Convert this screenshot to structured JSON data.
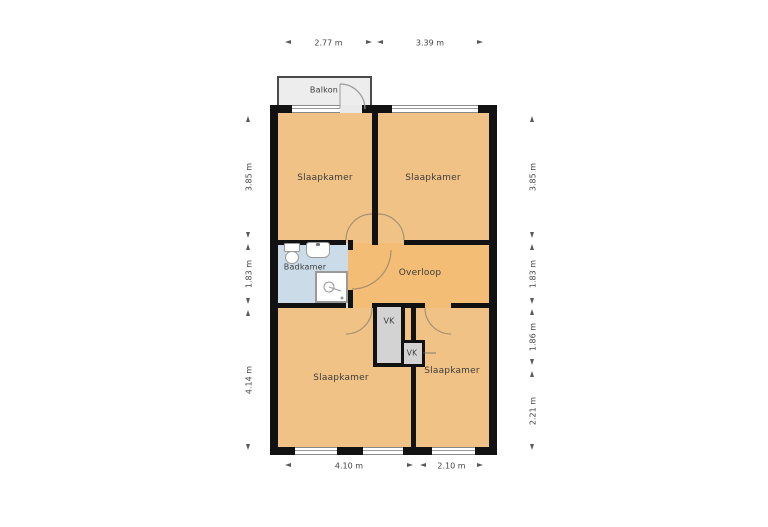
{
  "plan": {
    "type": "floor-plan",
    "rooms": {
      "balkon": {
        "label": "Balkon"
      },
      "slaapkamer_top_left": {
        "label": "Slaapkamer"
      },
      "slaapkamer_top_right": {
        "label": "Slaapkamer"
      },
      "badkamer": {
        "label": "Badkamer"
      },
      "overloop": {
        "label": "Overloop"
      },
      "slaapkamer_bottom_left": {
        "label": "Slaapkamer"
      },
      "slaapkamer_bottom_right": {
        "label": "Slaapkamer"
      },
      "vk_large": {
        "label": "VK"
      },
      "vk_small": {
        "label": "VK"
      }
    },
    "dimensions": {
      "top": [
        {
          "label": "2.77 m"
        },
        {
          "label": "3.39 m"
        }
      ],
      "bottom": [
        {
          "label": "4.10 m"
        },
        {
          "label": "2.10 m"
        }
      ],
      "left": [
        {
          "label": "3.85 m"
        },
        {
          "label": "1.83 m"
        },
        {
          "label": "4.14 m"
        }
      ],
      "right": [
        {
          "label": "3.85 m"
        },
        {
          "label": "1.83 m"
        },
        {
          "label": "1.86 m"
        },
        {
          "label": "2.21 m"
        }
      ]
    },
    "colors": {
      "bedroom_fill": "#f1c286",
      "hall_fill": "#f3bd76",
      "bathroom_fill": "#ccdbe8",
      "closet_fill": "#d3d3d3",
      "balcony_fill": "#ededed",
      "wall": "#121212"
    }
  }
}
